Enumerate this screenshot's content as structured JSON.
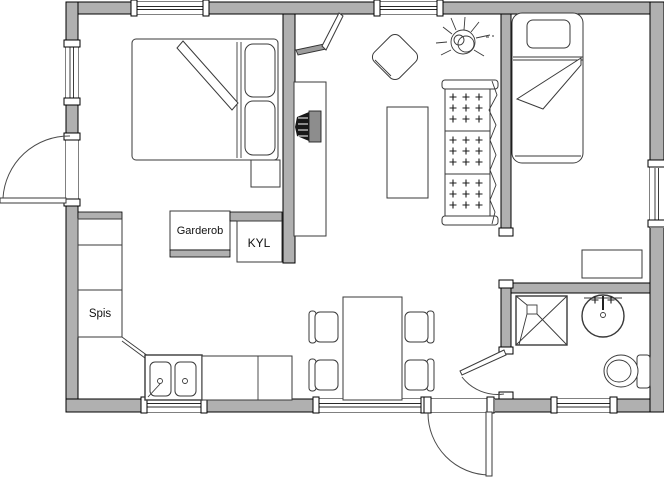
{
  "plan": {
    "title": "studio-cabin-floor-plan",
    "labels": {
      "wardrobe": "Garderob",
      "fridge": "KYL",
      "stove": "Spis"
    },
    "fixtures": [
      "double-bed",
      "nightstand",
      "wardrobe",
      "fridge",
      "stove",
      "kitchen-sink",
      "desk",
      "tv",
      "corner-shelf",
      "armchair",
      "coffee-table",
      "sofa",
      "plant",
      "dining-table",
      "dining-chair",
      "single-bed",
      "dresser",
      "shower",
      "washbasin",
      "toilet"
    ]
  },
  "colors": {
    "wall_fill": "#b0b0b0",
    "wall_stroke": "#000000",
    "furniture_stroke": "#3a3a3a",
    "text": "#111111",
    "tv_dark": "#181818",
    "tv_back": "#8d8d8d",
    "shelf_gray": "#9c9c9c"
  }
}
